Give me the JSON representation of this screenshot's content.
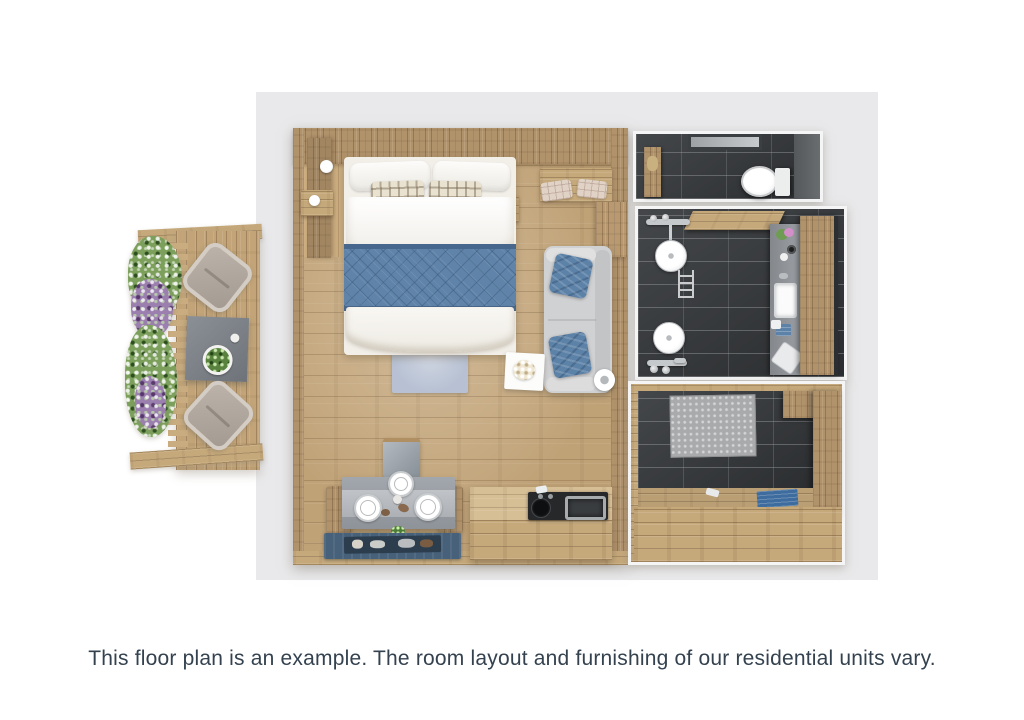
{
  "caption": {
    "text": "This floor plan is an example. The room layout and furnishing of our residential units vary."
  },
  "colors": {
    "page_bg": "#ffffff",
    "panel_bg": "#e9e9eb",
    "caption_text": "#344250",
    "wood_floor": "#c0a277",
    "wood_wall": "#b0926b",
    "wood_bench": "#c6a97b",
    "tile_dark": "#36393c",
    "tile_grout": "#9a9da0",
    "blanket_blue": "#5f83a9",
    "pillow_blue": "#5d82a8",
    "sofa_gray": "#d0d1d3",
    "rug_light_blue": "#b7c1d3",
    "rug_navy": "#47617a",
    "slate_gray": "#7e848b",
    "fixture_white": "#f8f8f9"
  }
}
